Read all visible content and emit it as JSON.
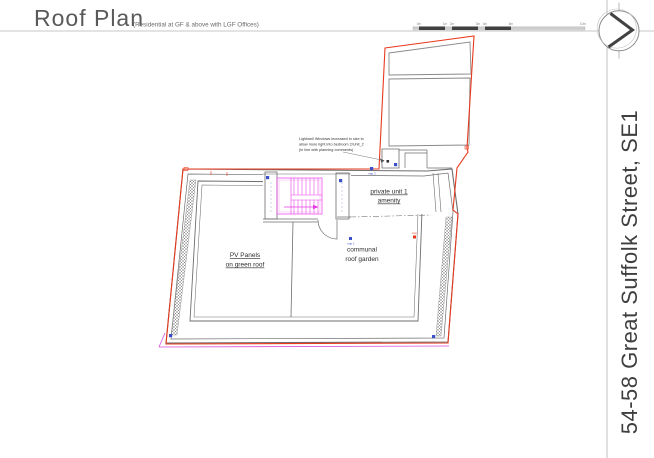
{
  "header": {
    "title": "Roof Plan",
    "subtitle": "(Residential at GF & above with LGF Offices)"
  },
  "title_block": {
    "project_title": "54-58 Great Suffolk Street, SE1"
  },
  "scale_bar": {
    "labels": [
      "0m",
      "1m",
      "2m",
      "3m",
      "4m",
      "5m"
    ],
    "end_label": "10m"
  },
  "plan": {
    "rooms": {
      "pv_panels": {
        "line1": "PV Panels",
        "line2": "on green roof"
      },
      "communal": {
        "line1": "communal",
        "line2": "roof garden"
      },
      "private_amenity": {
        "line1": "private unit 1",
        "line2": "amenity"
      }
    },
    "annotation": {
      "line1": "Lightwell Windows increased in size to",
      "line2": "allow more light into bedroom 2/Unit_2",
      "line3": "(in line with planning comments)"
    },
    "markers": {
      "rwp1": "rwp 1",
      "rwp2": "rwp 2",
      "svp": "svp"
    },
    "colors": {
      "site_boundary": "#e8391d",
      "walls": "#6e6e6e",
      "stair": "#e83ce8",
      "rwp_marker": "#3c50c8",
      "proposed_line": "#d94fd9"
    }
  }
}
